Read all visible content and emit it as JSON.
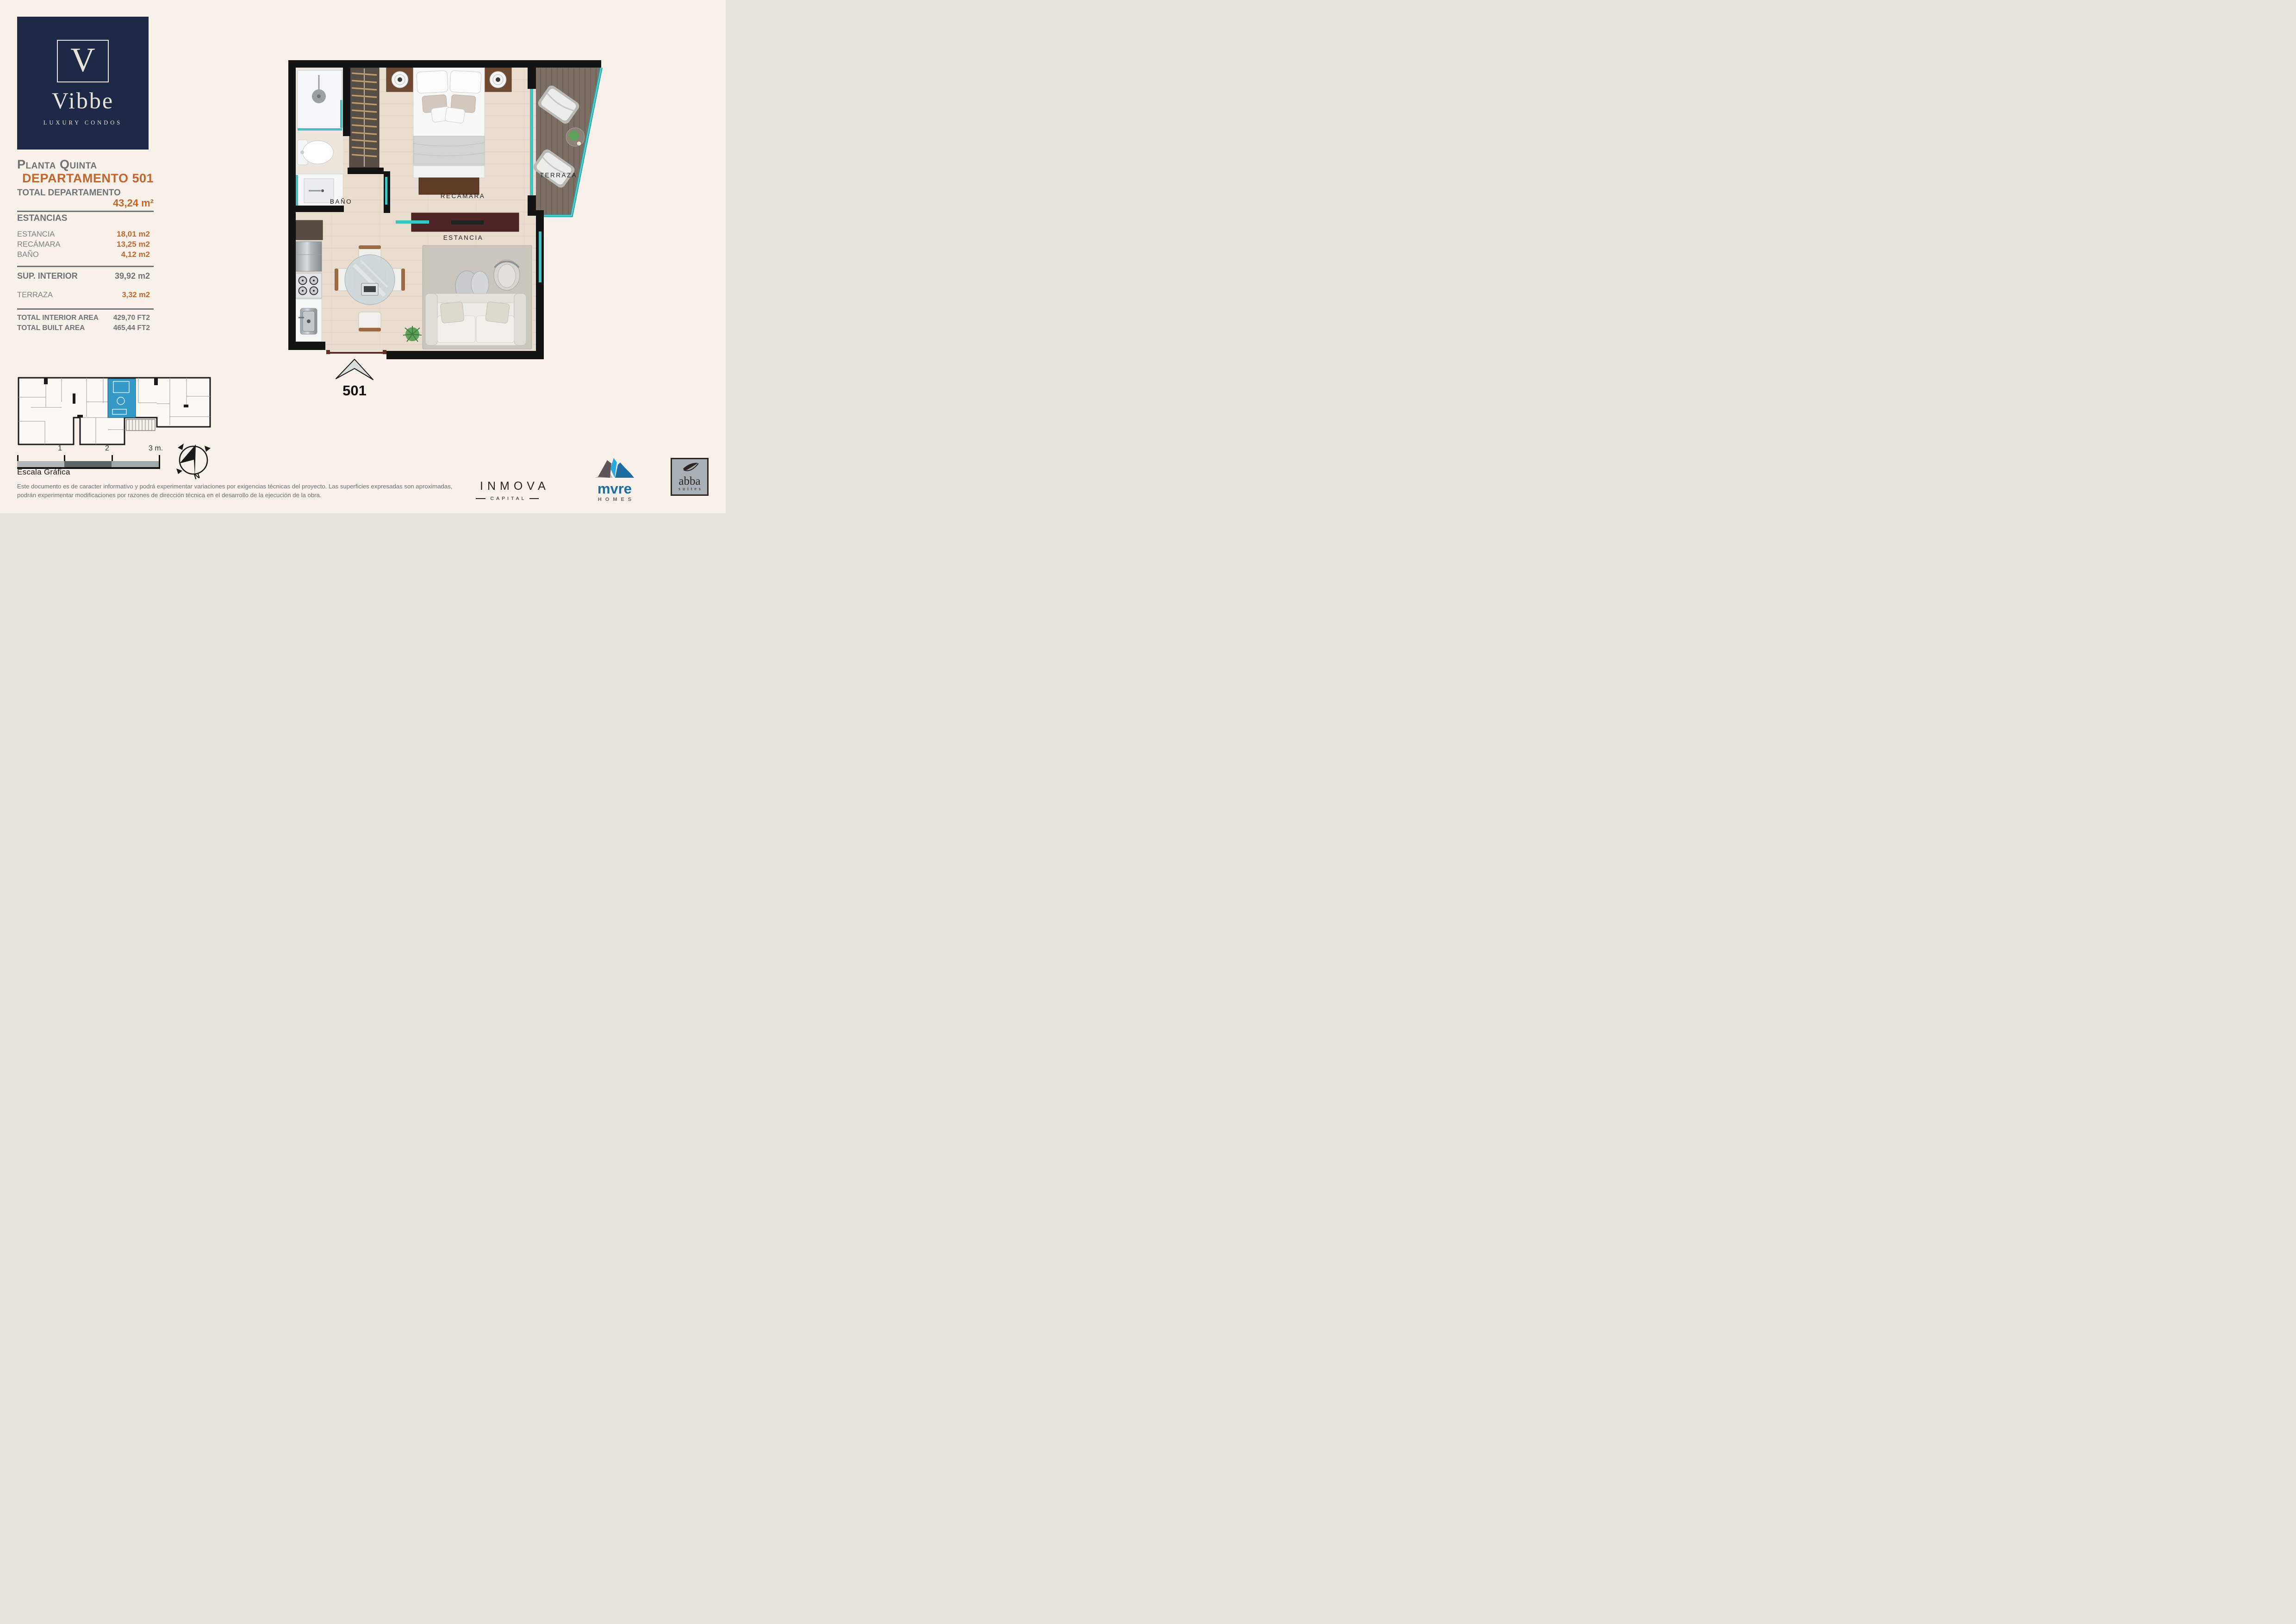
{
  "brand": {
    "letter": "V",
    "name": "Vibbe",
    "tagline": "LUXURY CONDOS"
  },
  "header": {
    "floor_label": "Planta Quinta",
    "unit_label": "DEPARTAMENTO 501"
  },
  "summary": {
    "total_label": "TOTAL DEPARTAMENTO",
    "total_value": "43,24 m²",
    "estancias_heading": "ESTANCIAS",
    "rooms": [
      {
        "label": "ESTANCIA",
        "value": "18,01 m2"
      },
      {
        "label": "RECÁMARA",
        "value": "13,25 m2"
      },
      {
        "label": "BAÑO",
        "value": "4,12 m2"
      }
    ],
    "sup_interior_label": "SUP. INTERIOR",
    "sup_interior_value": "39,92 m2",
    "terraza_label": "TERRAZA",
    "terraza_value": "3,32 m2",
    "totals": [
      {
        "label": "TOTAL INTERIOR AREA",
        "value": "429,70 FT2"
      },
      {
        "label": "TOTAL BUILT AREA",
        "value": "465,44 FT2"
      }
    ]
  },
  "floorplan": {
    "labels": {
      "bano": "BAÑO",
      "recamara": "RECÁMARA",
      "estancia": "ESTANCIA",
      "terraza": "TERRAZA"
    },
    "unit_number": "501"
  },
  "scale": {
    "title": "Escala Gráfica",
    "tick1": "1",
    "tick2": "2",
    "tick3": "3 m."
  },
  "compass": {
    "north_label": "N"
  },
  "disclaimer": {
    "line1": "Este documento es de caracter informativo y podrá experimentar variaciones por exigencias técnicas del proyecto. Las superficies expresadas son aproximadas,",
    "line2": "podrán experimentar modificaciones por razones de dirección técnica en el desarrollo de la ejecución de la obra."
  },
  "partners": {
    "inmova": {
      "name": "INMOVA",
      "sub": "CAPITAL"
    },
    "mvre": {
      "name": "mvre",
      "sub": "HOMES"
    },
    "abba": {
      "name": "abba",
      "sub": "suites"
    }
  },
  "colors": {
    "background": "#f8f1ea",
    "navy": "#1e2946",
    "cream": "#e7e3d8",
    "accent_orange": "#c3662e",
    "heading_gray": "#6e7377",
    "teal_glass": "#3fc4c2",
    "wall_black": "#131313",
    "mini_highlight": "#3599c7",
    "mvre_blue": "#1c6da0",
    "mvre_lightblue": "#2aa9de"
  }
}
